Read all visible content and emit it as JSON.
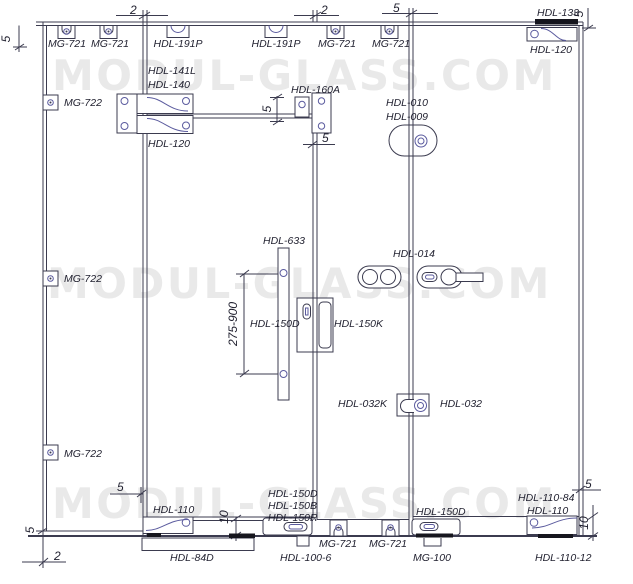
{
  "watermark": {
    "text": "MODUL-GLASS.COM",
    "color": "#e9e9e9"
  },
  "colors": {
    "line": "#3b3b4f",
    "accent": "#5b5b9e",
    "label": "#1f1f2e",
    "black": "#16161e"
  },
  "parts": {
    "mg721": "MG-721",
    "mg722": "MG-722",
    "mg100": "MG-100",
    "hdl191p": "HDL-191P",
    "hdl141l": "HDL-141L",
    "hdl140": "HDL-140",
    "hdl120": "HDL-120",
    "hdl160a": "HDL-160A",
    "hdl133": "HDL-133",
    "hdl633": "HDL-633",
    "hdl150d": "HDL-150D",
    "hdl150b": "HDL-150B",
    "hdl150r": "HDL-150R",
    "hdl150k": "HDL-150K",
    "hdl010": "HDL-010",
    "hdl009": "HDL-009",
    "hdl014": "HDL-014",
    "hdl032k": "HDL-032K",
    "hdl032": "HDL-032",
    "hdl110": "HDL-110",
    "hdl110_84": "HDL-110-84",
    "hdl110_12": "HDL-110-12",
    "hdl84d": "HDL-84D",
    "hdl100_6": "HDL-100-6"
  },
  "dimensions": {
    "gap2": "2",
    "gap5": "5",
    "gap10": "10",
    "handle_height_range": "275-900"
  }
}
